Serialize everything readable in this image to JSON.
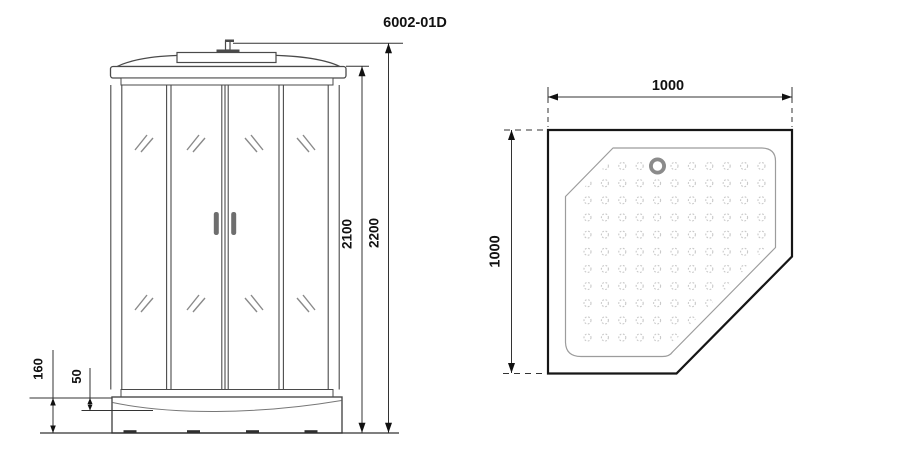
{
  "title": "6002-01D",
  "front_view": {
    "dims": {
      "overall_height": "2200",
      "cabin_height": "2100",
      "base_height": "160",
      "tray_lip": "50"
    }
  },
  "top_view": {
    "dims": {
      "width": "1000",
      "depth": "1000"
    },
    "anti_slip_pattern": {
      "cols": 11,
      "rows": 11,
      "origin_x": 587.5,
      "origin_y": 166,
      "dx": 17.4,
      "dy": 17.15,
      "dot_radius": 3.5
    }
  },
  "colors": {
    "drawing_line": "#4a4a4a",
    "dim_line": "#333333",
    "tray_outline": "#161616",
    "inner_outline": "#9c9c9c",
    "dot": "#c9c9c9",
    "drain": "#8b8b8b",
    "handle": "#6e6e6e"
  }
}
